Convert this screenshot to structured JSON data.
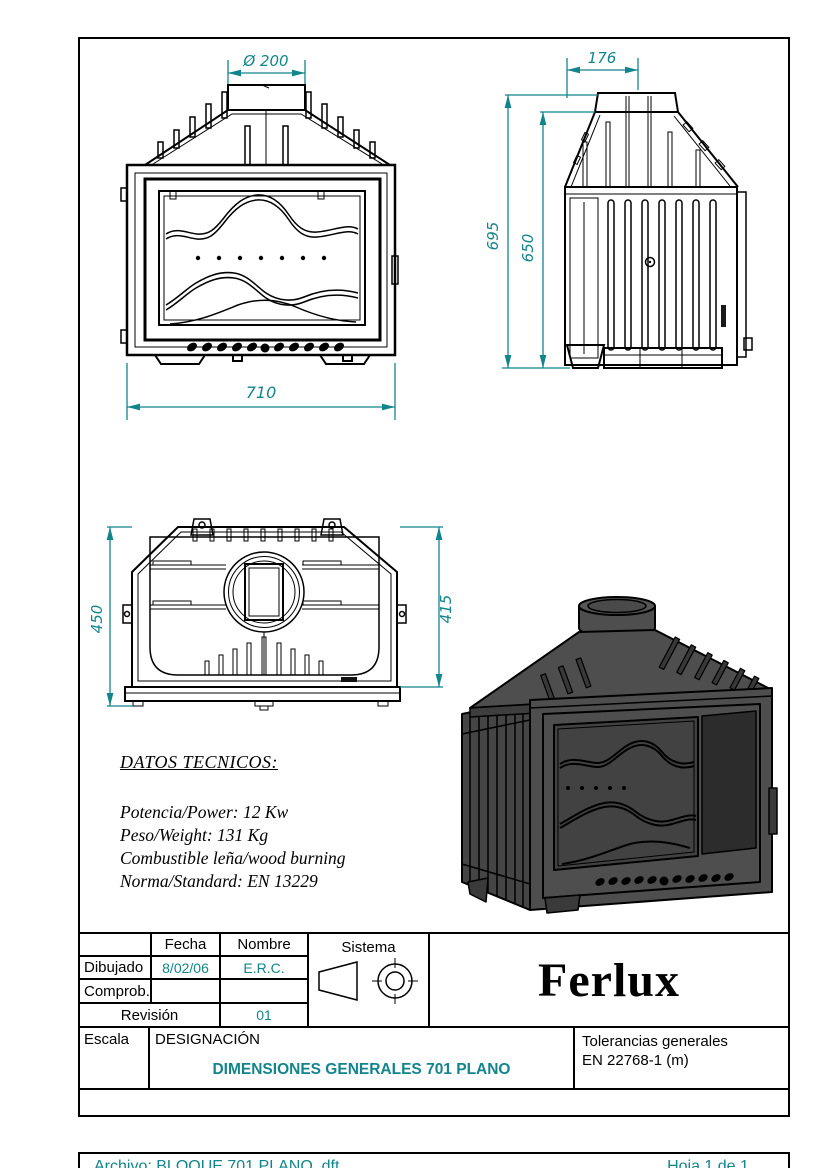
{
  "colors": {
    "accent": "#12858C",
    "line_black": "#000000",
    "render_gray": "#4E4E4E"
  },
  "views": {
    "front": {
      "flue_diameter": "Ø 200",
      "width": "710"
    },
    "side": {
      "depth_top": "176",
      "height_overall": "695",
      "height_body": "650"
    },
    "top": {
      "depth_overall": "450",
      "depth_body": "415"
    }
  },
  "tech_specs": {
    "title": "DATOS TECNICOS:",
    "lines": [
      "Potencia/Power: 12 Kw",
      "Peso/Weight: 131 Kg",
      "Combustible leña/wood burning",
      "Norma/Standard: EN 13229"
    ]
  },
  "title_block": {
    "col_fecha": "Fecha",
    "col_nombre": "Nombre",
    "row_dibujado": {
      "label": "Dibujado",
      "fecha": "8/02/06",
      "nombre": "E.R.C."
    },
    "row_comprob": {
      "label": "Comprob."
    },
    "row_revision": {
      "label": "Revisión",
      "value": "01"
    },
    "sistema_label": "Sistema",
    "brand": "Ferlux",
    "escala_label": "Escala",
    "designacion_label": "DESIGNACIÓN",
    "designacion_value": "DIMENSIONES GENERALES 701 PLANO",
    "tolerancias_line1": "Tolerancias generales",
    "tolerancias_line2": "EN 22768-1 (m)",
    "archivo": "Archivo: BLOQUE 701 PLANO .dft",
    "hoja": "Hoja 1 de 1"
  }
}
